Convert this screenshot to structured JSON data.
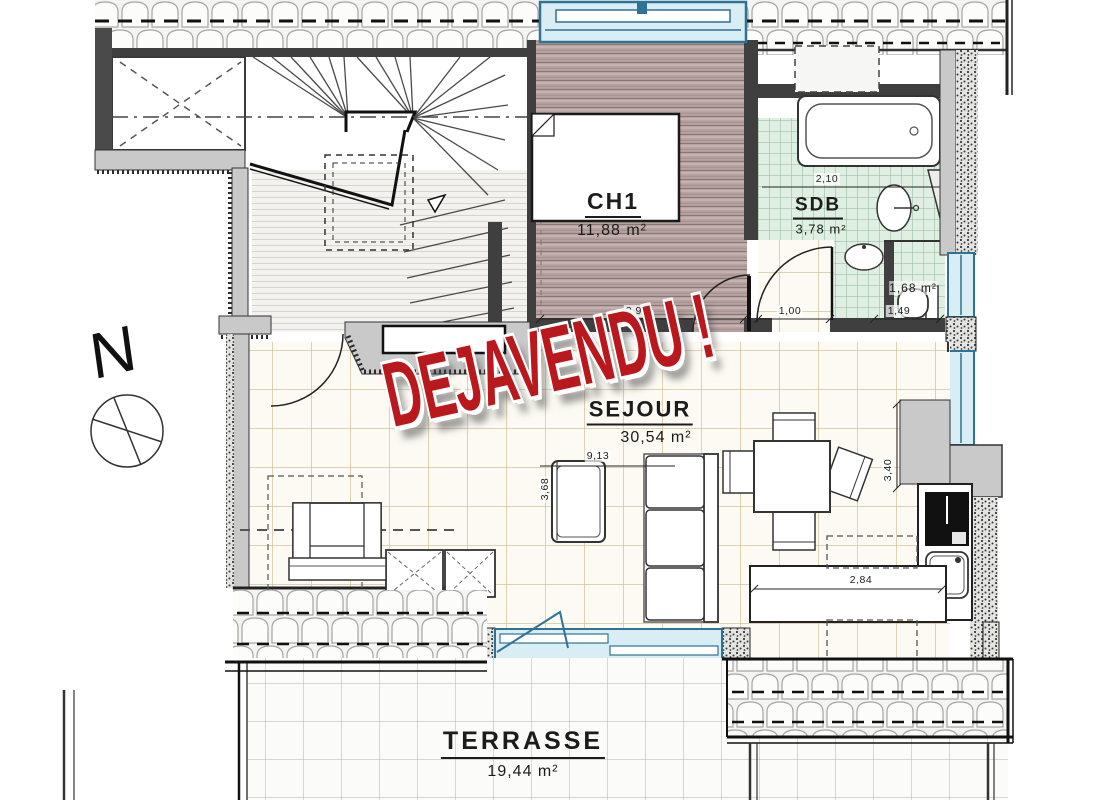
{
  "plan": {
    "stamp": "DEJAVENDU !",
    "compass_label": "N",
    "rooms": {
      "ch1": {
        "name": "CH1",
        "area": "11,88 m²"
      },
      "sdb": {
        "name": "SDB",
        "area": "3,78 m²"
      },
      "wc": {
        "area": "1,68 m²"
      },
      "sejour": {
        "name": "SEJOUR",
        "area": "30,54 m²"
      },
      "terrasse": {
        "name": "TERRASSE",
        "area": "19,44 m²"
      }
    },
    "dimensions": {
      "ch1_width": "2,90",
      "hall_width": "1,00",
      "sdb_width": "2,10",
      "wc_width": "1,49",
      "sejour_length": "9,13",
      "sejour_depth_left": "3,68",
      "sejour_depth_right": "3,40",
      "kitchen_run": "2,84"
    },
    "colors": {
      "stamp_red": "#b9191c",
      "window_blue": "#2e7295",
      "window_fill": "#d8edf4",
      "bedroom_floor": "#b7a3a0",
      "bath_tile": "#dff0e2",
      "sejour_tile_line": "#cbbc90",
      "wall_gray": "#c9c9c9"
    }
  }
}
